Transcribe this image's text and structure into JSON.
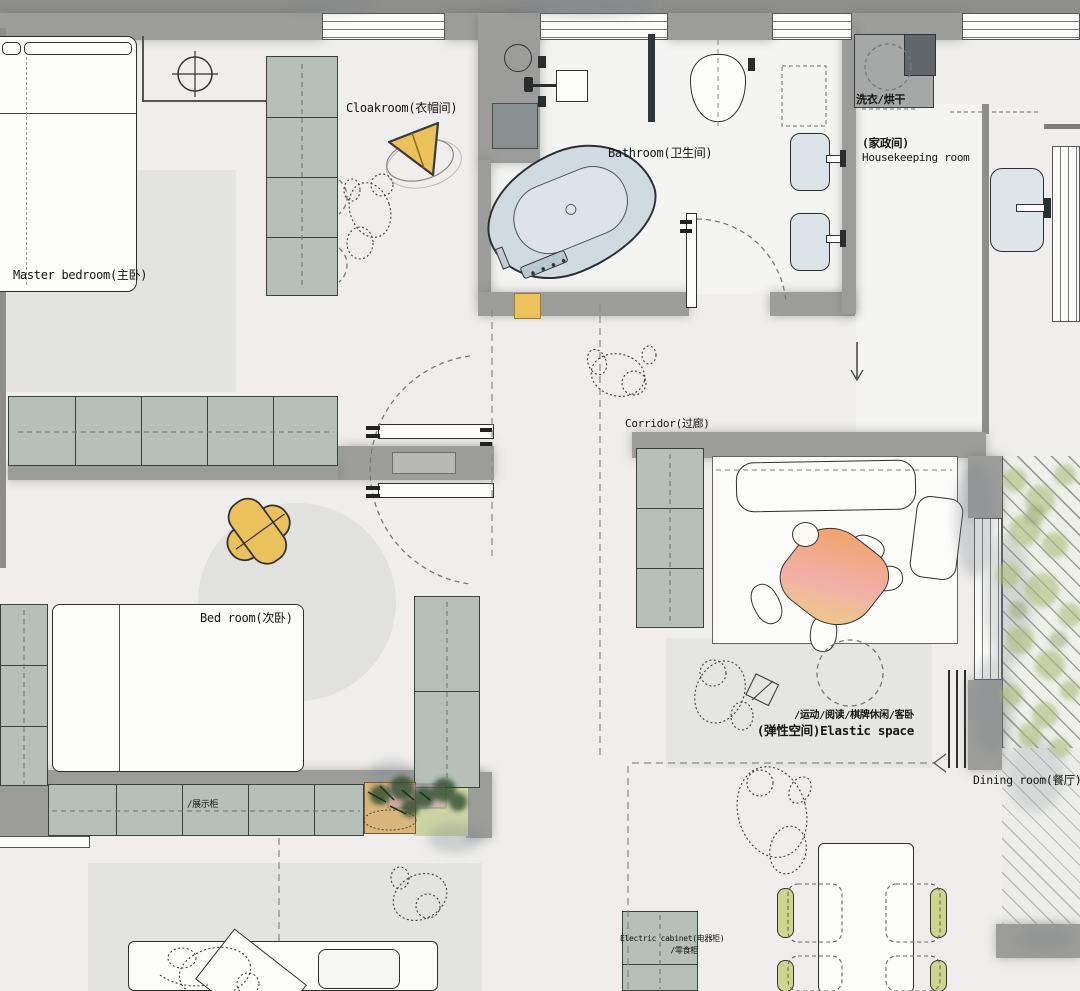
{
  "plan_title": "Apartment floor plan",
  "colors": {
    "floor": "#efeeec",
    "wall": "#9c9c9a",
    "cabinet_green": "#b5c0ba",
    "accent_yellow": "#ecc25d",
    "bathtub_blue": "#d0dae1",
    "chair_green": "#ccd68d",
    "blanket_orange": "#efa264",
    "blanket_pink": "#f2b0a8",
    "foliage_green": "#aebc7e"
  },
  "rooms": {
    "master_bedroom": {
      "label": "Master bedroom(主卧)"
    },
    "cloakroom": {
      "label": "Cloakroom(衣帽间)"
    },
    "bathroom": {
      "label": "Bathroom(卫生间)"
    },
    "laundry": {
      "label": "洗衣/烘干"
    },
    "housekeeping": {
      "label_cn": "(家政间)",
      "label_en": "Housekeeping room"
    },
    "corridor": {
      "label": "Corridor(过廊)"
    },
    "bedroom": {
      "label": "Bed room(次卧)"
    },
    "elastic_space": {
      "label_uses": "/运动/阅读/棋牌休闲/客卧",
      "label_name": "(弹性空间)Elastic space"
    },
    "dining_room": {
      "label": "Dining room(餐厅)"
    }
  },
  "cabinet_labels": {
    "display": "/展示柜",
    "electric": "Electric cabinet(电器柜)",
    "snack": "/零食柜"
  }
}
